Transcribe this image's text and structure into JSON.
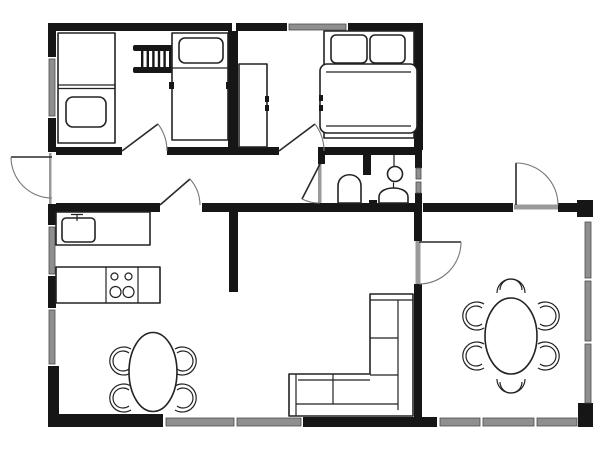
{
  "palette": {
    "background": "#ffffff",
    "wall": "#161616",
    "window": "#8f8f8f",
    "outline": "#222222",
    "door_arc": "#777777",
    "threshold": "#9a9a9a"
  },
  "floor_plan": {
    "type": "architectural-floor-plan",
    "rooms": [
      "kids-bedroom-two-single-beds",
      "master-bedroom-double-bed",
      "bathroom",
      "hallway",
      "kitchen-living-area",
      "dining-room"
    ],
    "furniture_symbols": [
      "single-bed-with-pillow",
      "bunk-ladder",
      "single-bed-with-pillow",
      "wardrobe",
      "double-bed-two-pillows",
      "toilet",
      "round-wash-basin",
      "wash-basin",
      "kitchen-sink-counter",
      "cooktop-four-burners",
      "oval-table-four-chairs",
      "l-shaped-sofa",
      "oval-table-six-chairs"
    ],
    "door_symbols": [
      "entrance-door-left-wall",
      "kids-bedroom-door",
      "master-bedroom-door",
      "bathroom-door",
      "hallway-door",
      "dining-exterior-door",
      "dining-interior-door"
    ],
    "window_symbols": [
      "top-wall-window",
      "left-wall-window-upper",
      "left-wall-window-middle",
      "left-wall-window-lower",
      "bathroom-right-window",
      "dining-right-window-upper",
      "dining-right-window-middle",
      "dining-right-window-lower",
      "bottom-wall-window-left",
      "bottom-wall-window-right"
    ]
  }
}
